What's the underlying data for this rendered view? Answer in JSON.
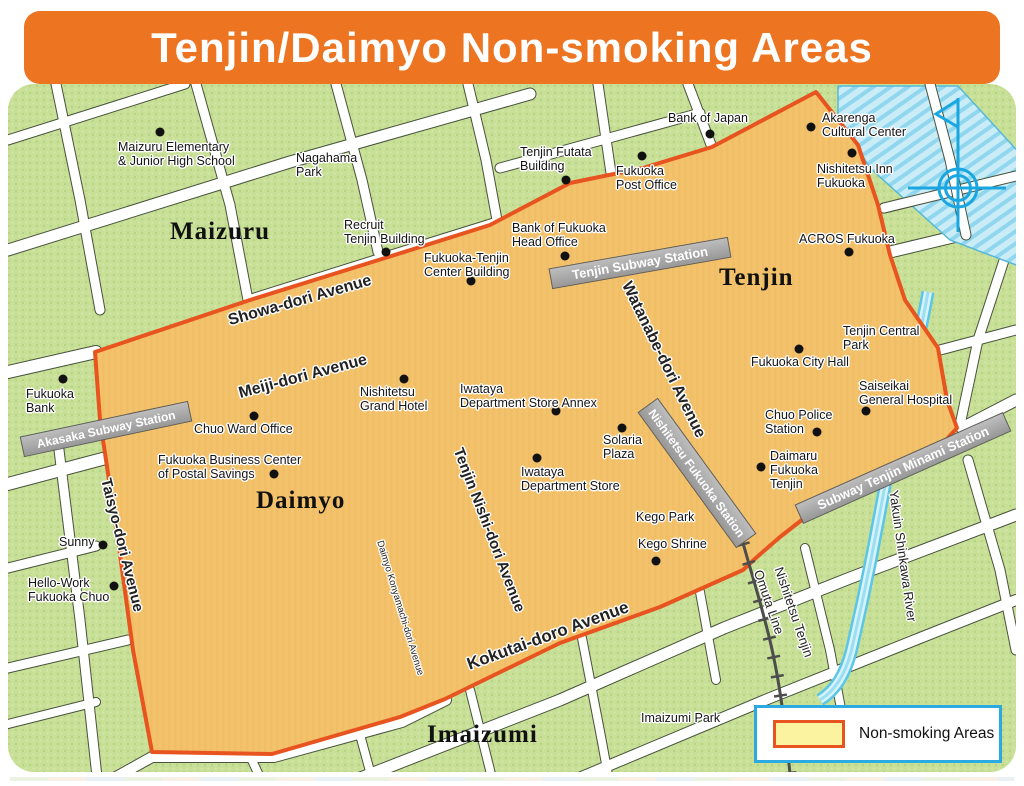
{
  "title": "Tenjin/Daimyo Non-smoking Areas",
  "legend": {
    "label": "Non-smoking Areas"
  },
  "districts": [
    {
      "name": "Maizuru"
    },
    {
      "name": "Tenjin"
    },
    {
      "name": "Daimyo"
    },
    {
      "name": "Imaizumi"
    }
  ],
  "streets": [
    {
      "label": "Showa-dori Avenue"
    },
    {
      "label": "Meiji-dori Avenue"
    },
    {
      "label": "Kokutai-doro Avenue"
    },
    {
      "label": "Watanabe-dori Avenue"
    },
    {
      "label": "Tenjin Nishi-dori Avenue"
    },
    {
      "label": "Taisyo-dori Avenue"
    },
    {
      "label": "Daimyo Konyamachi-dori Avenue"
    }
  ],
  "railway": {
    "line1": "Nishitetsu Tenjin",
    "line2": "Omuta Line"
  },
  "river": {
    "label": "Yakuin Shinkawa River"
  },
  "stations": [
    {
      "name": "Tenjin Subway Station"
    },
    {
      "name": "Akasaka Subway Station"
    },
    {
      "name": "Subway Tenjin Minami Station"
    },
    {
      "name": "Nishitetsu Fukuoka Station"
    }
  ],
  "pois": [
    {
      "lines": [
        "Maizuru Elementary",
        "& Junior High School"
      ]
    },
    {
      "lines": [
        "Nagahama",
        "Park"
      ]
    },
    {
      "lines": [
        "Bank of Japan"
      ]
    },
    {
      "lines": [
        "Akarenga",
        "Cultural Center"
      ]
    },
    {
      "lines": [
        "Nishitetsu Inn",
        "Fukuoka"
      ]
    },
    {
      "lines": [
        "Tenjin Futata",
        "Building"
      ]
    },
    {
      "lines": [
        "Fukuoka",
        "Post Office"
      ]
    },
    {
      "lines": [
        "Bank of Fukuoka",
        "Head Office"
      ]
    },
    {
      "lines": [
        "Recruit",
        "Tenjin Building"
      ]
    },
    {
      "lines": [
        "Fukuoka-Tenjin",
        "Center Building"
      ]
    },
    {
      "lines": [
        "ACROS Fukuoka"
      ]
    },
    {
      "lines": [
        "Fukuoka City Hall"
      ]
    },
    {
      "lines": [
        "Tenjin Central",
        "Park"
      ]
    },
    {
      "lines": [
        "Saiseikai",
        "General Hospital"
      ]
    },
    {
      "lines": [
        "Chuo Police",
        "Station"
      ]
    },
    {
      "lines": [
        "Daimaru",
        "Fukuoka",
        "Tenjin"
      ]
    },
    {
      "lines": [
        "Chuo Ward Office"
      ]
    },
    {
      "lines": [
        "Fukuoka",
        "Bank"
      ]
    },
    {
      "lines": [
        "Fukuoka Business Center",
        "of Postal Savings"
      ]
    },
    {
      "lines": [
        "Nishitetsu",
        "Grand Hotel"
      ]
    },
    {
      "lines": [
        "Iwataya",
        "Department Store Annex"
      ]
    },
    {
      "lines": [
        "Solaria",
        "Plaza"
      ]
    },
    {
      "lines": [
        "Iwataya",
        "Department Store"
      ]
    },
    {
      "lines": [
        "Kego Park"
      ]
    },
    {
      "lines": [
        "Kego Shrine"
      ]
    },
    {
      "lines": [
        "Sunny"
      ]
    },
    {
      "lines": [
        "Hello-Work",
        "Fukuoka Chuo"
      ]
    },
    {
      "lines": [
        "Imaizumi Park"
      ]
    }
  ],
  "colors": {
    "banner": "#ED7421",
    "boundary": "#E8541F",
    "nonsmoking_street": "#FCF3A1",
    "nonsmoking_block": "#F3C26D",
    "map_green": "#C7DF96",
    "water": "#8FD6EE",
    "station_band": "#A9A9A9",
    "legend_border": "#2BAAE2"
  }
}
